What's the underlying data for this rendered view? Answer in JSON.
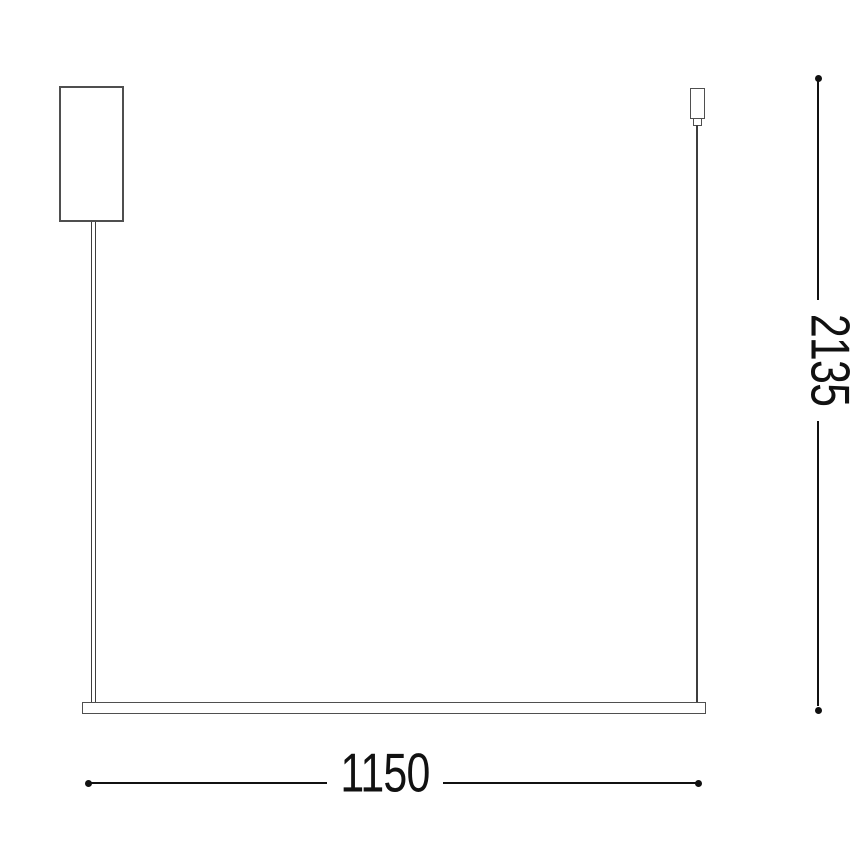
{
  "dimensions": {
    "width_label": "1150",
    "height_label": "2135"
  },
  "colors": {
    "outline": "#4f4f4f",
    "cable": "#3d3d3d",
    "dimension": "#111111",
    "background": "#ffffff"
  }
}
